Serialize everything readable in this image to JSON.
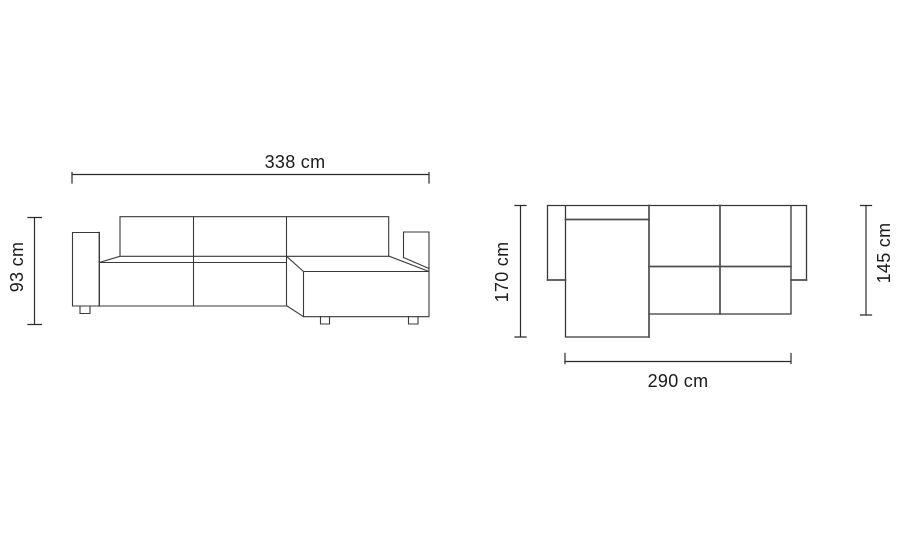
{
  "colors": {
    "background": "#ffffff",
    "drawing_line": "#3a3a3a",
    "divider_line": "#4d4d4d",
    "dimension_line": "#2b2b2b",
    "label_text": "#1a1a1a"
  },
  "front_view": {
    "width_label": "338 cm",
    "height_label": "93 cm"
  },
  "top_view": {
    "depth_total_label": "170 cm",
    "depth_seat_label": "145 cm",
    "width_label": "290 cm"
  }
}
